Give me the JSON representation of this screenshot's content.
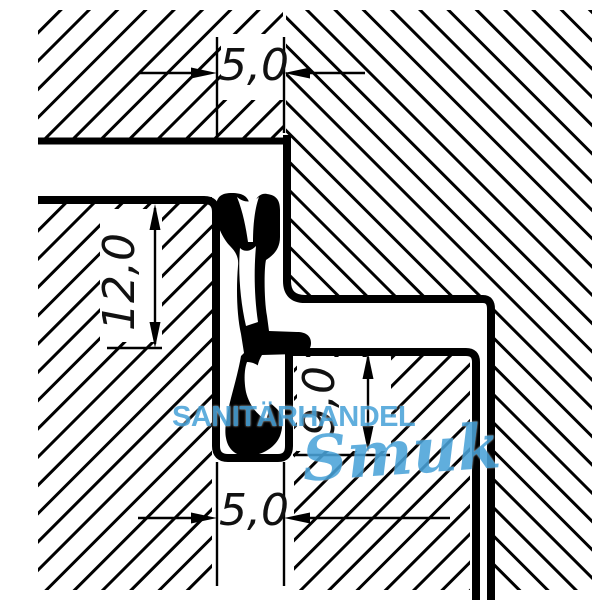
{
  "drawing": {
    "title": "seal-profile-cross-section",
    "dimensions": {
      "groove_width_top": "5,0",
      "depth_left": "12,0",
      "height_right": "9,0",
      "groove_width_bottom": "5,0"
    },
    "watermark": {
      "line1": "SANITÄRHANDEL",
      "line2": "Smuk",
      "color": "#4BA3D9"
    },
    "colors": {
      "line": "#000000",
      "background": "#FFFFFF",
      "seal_fill": "#000000"
    }
  }
}
